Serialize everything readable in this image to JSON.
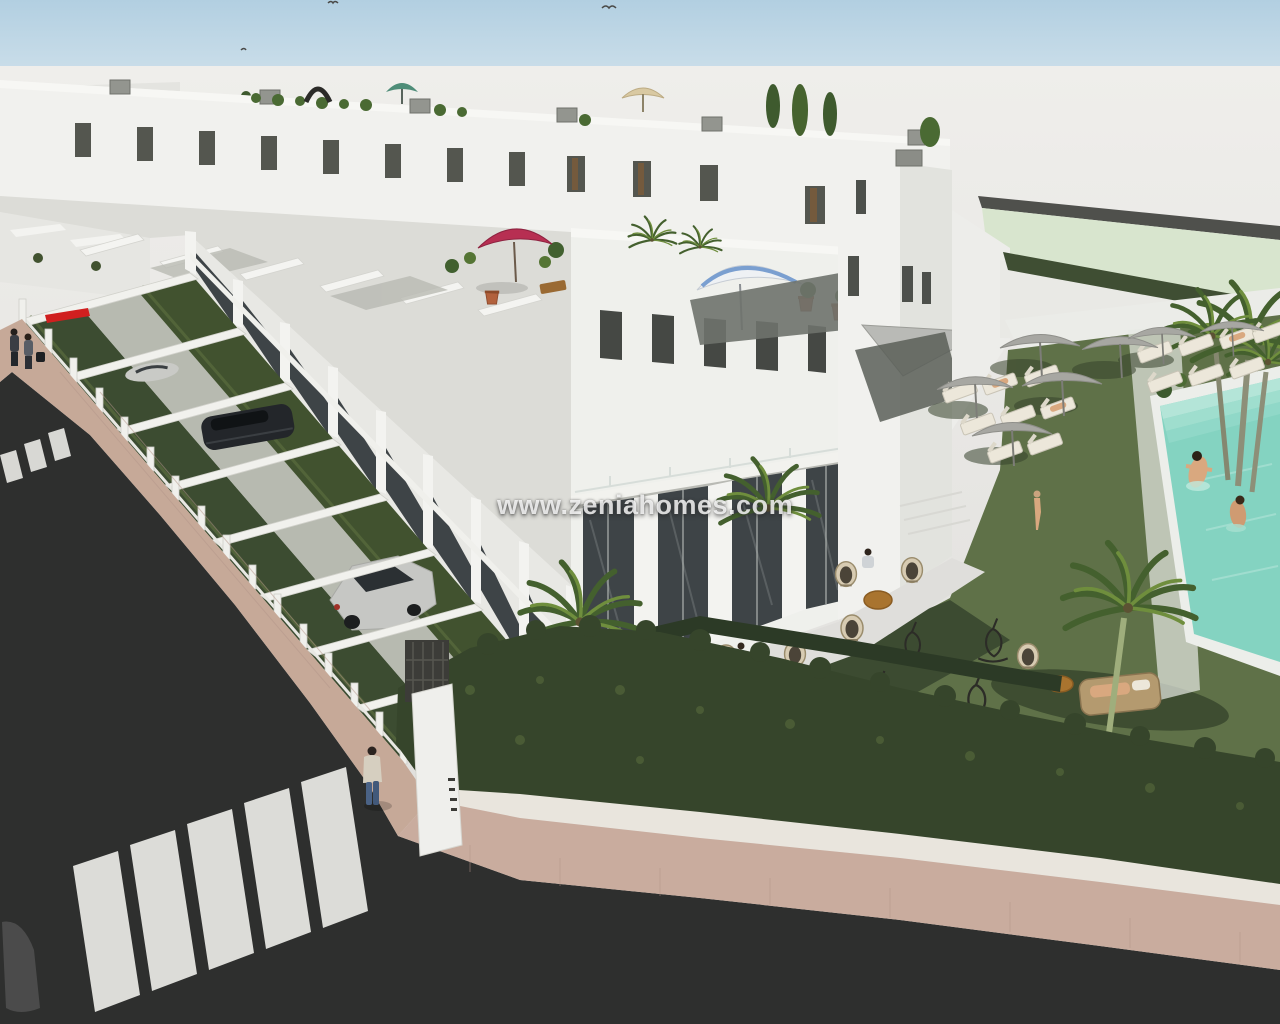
{
  "watermark": {
    "text": "www.zeniahomes.com"
  },
  "scene": {
    "alt": "Aerial 3D render of a new-build development: rows of white terraced townhouses with roof terraces and umbrellas, front yards with hedges and parked cars, communal lawn with wicker furniture, grey parasols, sun loungers, palm trees and a turquoise swimming pool with swimmers, streets with zebra crossings and pedestrians"
  },
  "palette": {
    "sky": "#b7d3e3",
    "backdrop": "#e9e8e5",
    "building_white": "#f2f2ef",
    "window_dark": "#4b4e4a",
    "glass": "#3e4447",
    "hedge_dark": "#31402a",
    "hedge_mid": "#44552f",
    "lawn": "#5f7148",
    "lawn_shadow": "#3a4930",
    "pool_water": "#84d3c1",
    "asphalt": "#2e2f2e",
    "sidewalk_tan": "#c6a998",
    "curb_cream": "#e9e5dd",
    "parasol_gray": "#a7a7a2",
    "umbrella_crimson": "#b72f52",
    "umbrella_beige": "#d9c9a2",
    "umbrella_teal": "#4e8d78",
    "umbrella_stripe_blue": "#7a9fd0",
    "awning_red": "#d01f1f",
    "adjacent_lot_green": "#d8e5ce",
    "car_yellow": "#c2a13e",
    "terracotta": "#b2613c",
    "skin": "#d9a87f"
  }
}
